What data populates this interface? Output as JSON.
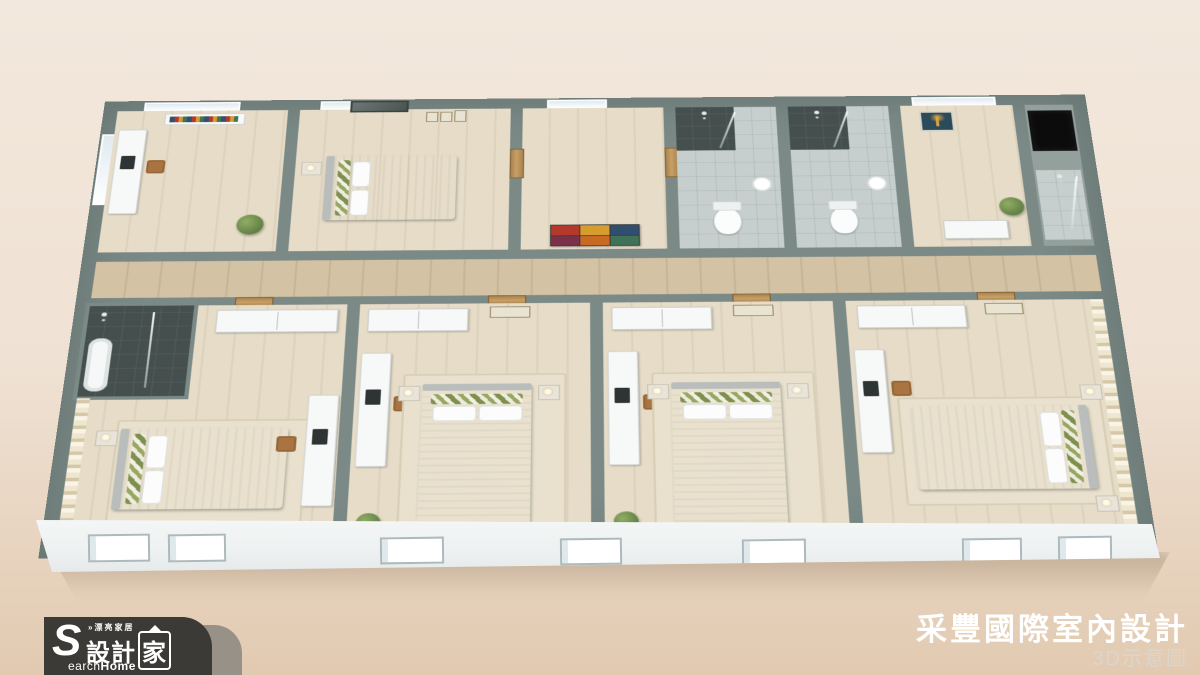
{
  "watermark": {
    "tagline": "»漂亮家居",
    "brand_initial": "S",
    "brand_main": "設計",
    "brand_boxed": "家",
    "brand_en_rest": "earch",
    "brand_en_bold": "Home"
  },
  "footer": {
    "company": "采豐國際室內設計",
    "caption": "3D示意圖"
  },
  "palette": {
    "bg-top": "#f3e8dd",
    "bg-mid": "#efe1d3",
    "bg-bottom": "#e2cab1",
    "wall": "#7b8a87",
    "wall-light": "#93a09c",
    "floor": "#e6dcc8",
    "floor-dark": "#d3c2a3",
    "tile-light": "#c6cfce",
    "tile-dark": "#454f4d",
    "surface": "#f7f8f8",
    "bed-green": "#7d9050",
    "desk": "#b98d5f",
    "chair": "#a9743f",
    "rug": "#e9e1cd",
    "plant": "#5f7c44",
    "shaft": "#0c0c0c",
    "window": "#dfeaf0",
    "facade": "#f5f7f7",
    "tree-bg": "#2b4a5c",
    "tree-fg": "#d9a441",
    "logo-bg": "#3b3a37",
    "logo-tab": "#8f8b83",
    "text-white": "#ffffff",
    "caption": "#dcd5ca",
    "shadow": "rgba(110,85,60,0.30)"
  },
  "artwork": {
    "abstract_colors": [
      "#b5392b",
      "#d79c2e",
      "#2f4e70",
      "#7b3049",
      "#c86a24",
      "#3f7257"
    ]
  },
  "scene": {
    "description": "3D isometric dollhouse cutaway rendering of an apartment floor plan, viewed from above",
    "rooms": [
      {
        "name": "study",
        "contents": [
          "desk",
          "laptop",
          "bookshelf",
          "plant",
          "window"
        ]
      },
      {
        "name": "master-bedroom",
        "contents": [
          "double-bed",
          "wall-tv",
          "picture-frames",
          "window"
        ]
      },
      {
        "name": "entry-foyer",
        "contents": [
          "abstract-painting",
          "wood-doors",
          "window"
        ]
      },
      {
        "name": "bathroom-1",
        "contents": [
          "toilet",
          "shower-stall",
          "sink"
        ]
      },
      {
        "name": "bathroom-2",
        "contents": [
          "toilet",
          "shower-stall",
          "sink"
        ]
      },
      {
        "name": "bedroom-top-right",
        "contents": [
          "tree-painting",
          "dresser",
          "plant",
          "window"
        ]
      },
      {
        "name": "utility-core",
        "contents": [
          "elevator-shaft",
          "shower-room"
        ]
      },
      {
        "name": "hallway",
        "contents": [
          "wood-floor",
          "doors"
        ]
      },
      {
        "name": "bedroom-1",
        "contents": [
          "double-bed",
          "green-striped-pillows",
          "wardrobe",
          "desk",
          "dark-tile-shower",
          "bathtub",
          "striped-accent-wall"
        ]
      },
      {
        "name": "bedroom-2",
        "contents": [
          "double-bed",
          "green-striped-pillows",
          "wardrobe",
          "desk",
          "chair",
          "nightstands",
          "lamps",
          "rug",
          "plant"
        ]
      },
      {
        "name": "bedroom-3",
        "contents": [
          "double-bed",
          "green-striped-pillows",
          "wardrobe",
          "desk",
          "chair",
          "nightstands",
          "lamps",
          "rug",
          "plant"
        ]
      },
      {
        "name": "bedroom-4",
        "contents": [
          "double-bed",
          "green-striped-pillows",
          "wardrobe",
          "desk",
          "chair",
          "nightstands",
          "lamps",
          "rug",
          "striped-accent-wall"
        ]
      }
    ]
  }
}
